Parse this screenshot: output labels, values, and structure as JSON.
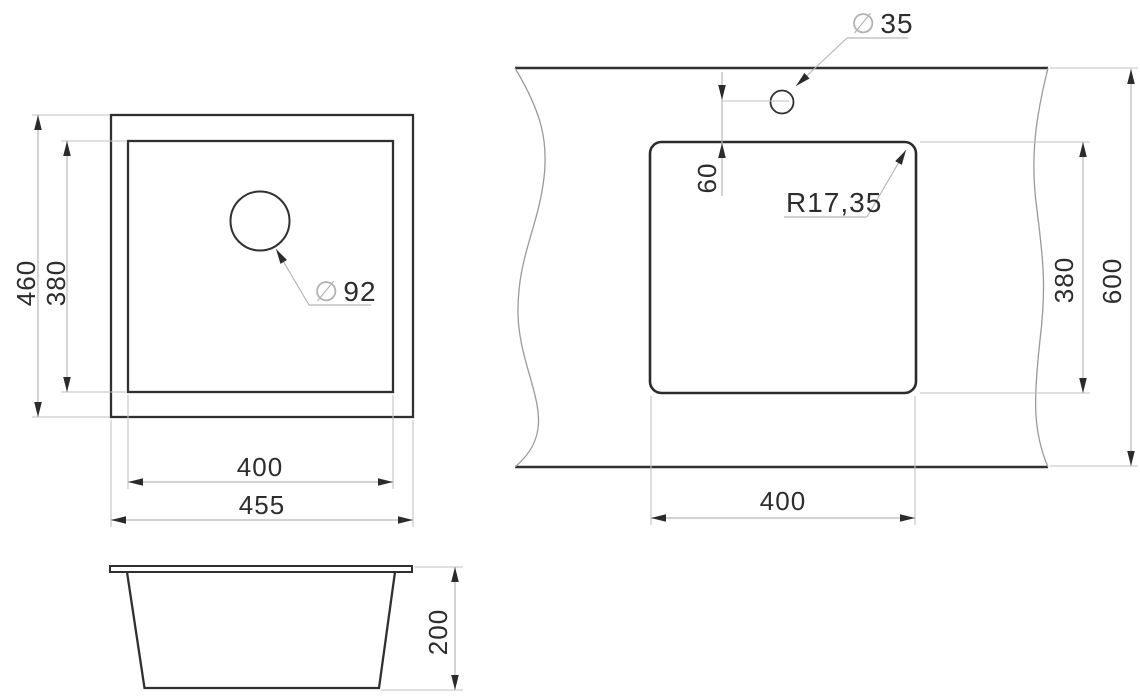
{
  "title": "Sink technical dimension drawing",
  "symbols": {
    "diameter": "∅"
  },
  "colors": {
    "background": "#ffffff",
    "object_line": "#303030",
    "dimension_line": "#b7b7b7",
    "arrow": "#2b2b2b",
    "text": "#2d2d2d",
    "diameter_symbol": "#b2b2b2"
  },
  "top_view": {
    "outer_height": "460",
    "inner_height": "380",
    "inner_width": "400",
    "outer_width": "455",
    "drain_diameter": "92"
  },
  "side_view": {
    "depth": "200"
  },
  "cutout_view": {
    "faucet_diameter": "35",
    "faucet_offset": "60",
    "corner_radius": "R17,35",
    "cutout_height": "380",
    "counter_depth": "600",
    "cutout_width": "400"
  }
}
